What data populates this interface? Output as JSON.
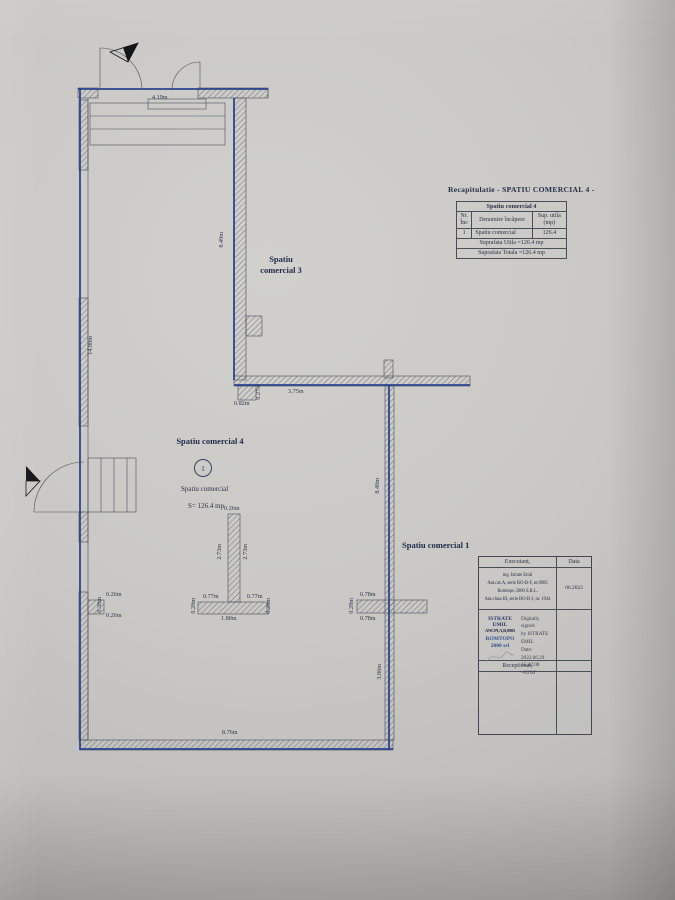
{
  "colors": {
    "paper": "#c9c8c5",
    "plan_blue": "#2a4590",
    "ink": "#2c3346"
  },
  "rooms": {
    "room3": {
      "label": "Spatiu\ncomercial 3"
    },
    "room4": {
      "title": "Spatiu comercial 4",
      "number": "1",
      "name": "Spatiu comercial",
      "area": "S= 126.4 mp"
    },
    "room1": {
      "label": "Spatiu comercial 1"
    }
  },
  "dims": [
    "4.19m",
    "8.49m",
    "14.88m",
    "0.82m",
    "0.27m",
    "3.75m",
    "8.48m",
    "0.26m",
    "0.38m",
    "0.26m",
    "0.26m",
    "2.73m",
    "2.73m",
    "0.77m",
    "0.77m",
    "1.80m",
    "0.28m",
    "0.28m",
    "0.78m",
    "0.78m",
    "0.28m",
    "3.86m",
    "8.76m"
  ],
  "recap": {
    "title": "Recapitulatie - SPATIU  COMERCIAL 4 -",
    "table": {
      "header": "Spatiu comercial 4",
      "columns": [
        "Nr.\nÎnc",
        "Denumire încăpere",
        "Sup. utila\n(mp)"
      ],
      "rows": [
        [
          "1",
          "Spatiu comercial",
          "126.4"
        ]
      ],
      "subtotal": "Suprafata Utila =126.4 mp",
      "total": "Suprafata Totala =126.4 mp"
    }
  },
  "titleblock": {
    "executant_label": "Executant,",
    "date_label": "Data",
    "executant_lines": [
      "ing. Istrate Emil",
      "Aut.cat.A, serie RO-B-F, nr.0985",
      "Romtopo 2000 S.R.L.",
      "Aut.clasa III, serie RO-B-J, nr. 1944"
    ],
    "date_value": "06.2022",
    "stamp": {
      "line1": "ISTRATE EMIL",
      "line2": "ANCPI,A,B,0985",
      "line3": "ROMTOPO 2000 srl"
    },
    "signature": {
      "line1": "Digitally signed",
      "line2": "by ISTRATE EMIL",
      "line3": "Date: 2022.06.29",
      "line4": "15:42:08 +03'00'"
    },
    "receptionat_label": "Receptionat,"
  }
}
